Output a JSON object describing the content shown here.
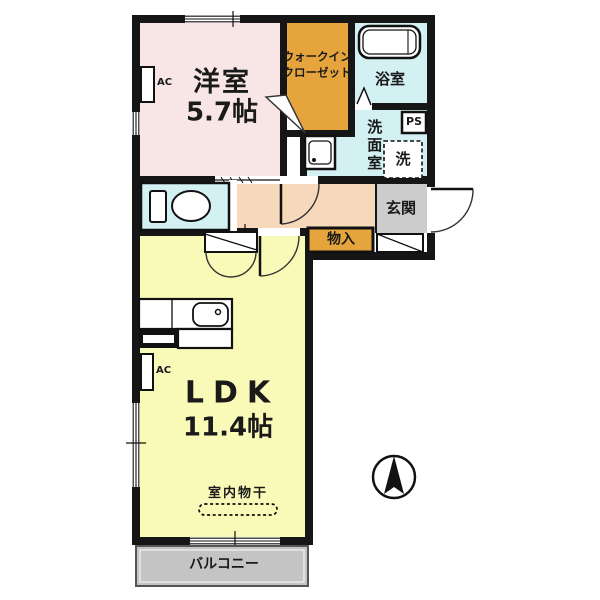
{
  "rooms": {
    "bedroom": {
      "name": "洋室",
      "size": "5.7帖"
    },
    "wic": {
      "line1": "ウォークイン",
      "line2": "クローゼット"
    },
    "bath": {
      "name": "浴室"
    },
    "washroom": {
      "name": "洗面室"
    },
    "laundry": {
      "name": "洗"
    },
    "ps": {
      "name": "PS"
    },
    "entrance": {
      "name": "玄関"
    },
    "storage": {
      "name": "物入"
    },
    "ldk": {
      "name": "LDK",
      "size": "11.4帖"
    },
    "drying": {
      "name": "室内物干"
    },
    "balcony": {
      "name": "バルコニー"
    },
    "ac": {
      "name": "AC"
    }
  },
  "colors": {
    "bedroom": "#f8e5e5",
    "closet_storage": "#e6a43d",
    "wet_rooms": "#d3f0f2",
    "hallway": "#f6d8ba",
    "ldk": "#fafab8",
    "entrance": "#cccccc",
    "balcony": "#c4c4c4",
    "walls": "#161616"
  }
}
